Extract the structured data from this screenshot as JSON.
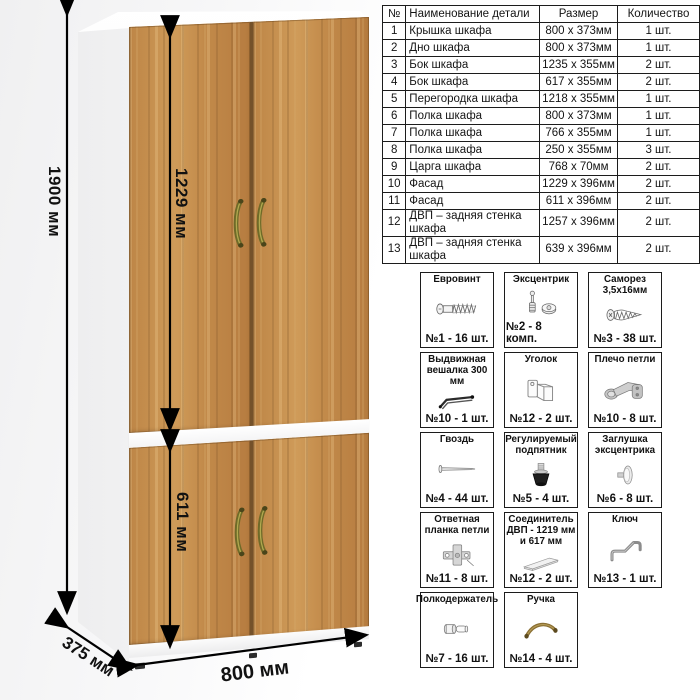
{
  "diagram": {
    "dimensions": {
      "height": "1900 мм",
      "upper_door_height": "1229 мм",
      "lower_door_height": "611 мм",
      "width": "800 мм",
      "depth": "375 мм"
    },
    "colors": {
      "wood": "#c38c4c",
      "carcass": "#ffffff",
      "handle_bronze": "#6f6a28"
    }
  },
  "parts_table": {
    "headers": [
      "№",
      "Наименование детали",
      "Размер",
      "Количество"
    ],
    "rows": [
      [
        "1",
        "Крышка шкафа",
        "800 x 373мм",
        "1 шт."
      ],
      [
        "2",
        "Дно шкафа",
        "800 x 373мм",
        "1 шт."
      ],
      [
        "3",
        "Бок шкафа",
        "1235 x 355мм",
        "2 шт."
      ],
      [
        "4",
        "Бок шкафа",
        "617 x 355мм",
        "2 шт."
      ],
      [
        "5",
        "Перегородка шкафа",
        "1218 x 355мм",
        "1 шт."
      ],
      [
        "6",
        "Полка шкафа",
        "800 x 373мм",
        "1 шт."
      ],
      [
        "7",
        "Полка шкафа",
        "766 x 355мм",
        "1 шт."
      ],
      [
        "8",
        "Полка шкафа",
        "250 x 355мм",
        "3 шт."
      ],
      [
        "9",
        "Царга шкафа",
        "768 x 70мм",
        "2 шт."
      ],
      [
        "10",
        "Фасад",
        "1229 x 396мм",
        "2 шт."
      ],
      [
        "11",
        "Фасад",
        "611 x 396мм",
        "2 шт."
      ],
      [
        "12",
        "ДВП – задняя стенка шкафа",
        "1257 x 396мм",
        "2 шт."
      ],
      [
        "13",
        "ДВП – задняя стенка шкафа",
        "639 x 396мм",
        "2 шт."
      ]
    ]
  },
  "hardware": {
    "items": [
      {
        "name": "Евровинт",
        "qty": "№1 - 16 шт.",
        "icon": "euro-screw-icon"
      },
      {
        "name": "Эксцентрик",
        "qty": "№2 - 8 комп.",
        "icon": "cam-lock-icon"
      },
      {
        "name": "Саморез 3,5x16мм",
        "qty": "№3 - 38 шт.",
        "icon": "self-tapping-screw-icon"
      },
      {
        "name": "Выдвижная вешалка 300 мм",
        "qty": "№10 - 1 шт.",
        "icon": "pull-out-rail-icon"
      },
      {
        "name": "Уголок",
        "qty": "№12 - 2 шт.",
        "icon": "corner-bracket-icon"
      },
      {
        "name": "Плечо петли",
        "qty": "№10 - 8 шт.",
        "icon": "hinge-arm-icon"
      },
      {
        "name": "Гвоздь",
        "qty": "№4 - 44 шт.",
        "icon": "nail-icon"
      },
      {
        "name": "Регулируемый подпятник",
        "qty": "№5 - 4 шт.",
        "icon": "adjustable-foot-icon"
      },
      {
        "name": "Заглушка эксцентрика",
        "qty": "№6 - 8 шт.",
        "icon": "cam-cover-icon"
      },
      {
        "name": "Ответная планка петли",
        "qty": "№11 - 8 шт.",
        "icon": "hinge-plate-icon"
      },
      {
        "name": "Соединитель ДВП - 1219 мм и 617 мм",
        "qty": "№12 - 2 шт.",
        "icon": "hdf-connector-icon"
      },
      {
        "name": "Ключ",
        "qty": "№13 - 1 шт.",
        "icon": "hex-key-icon"
      },
      {
        "name": "Полкодержатель",
        "qty": "№7 - 16 шт.",
        "icon": "shelf-pin-icon"
      },
      {
        "name": "Ручка",
        "qty": "№14 - 4 шт.",
        "icon": "handle-icon"
      }
    ]
  }
}
